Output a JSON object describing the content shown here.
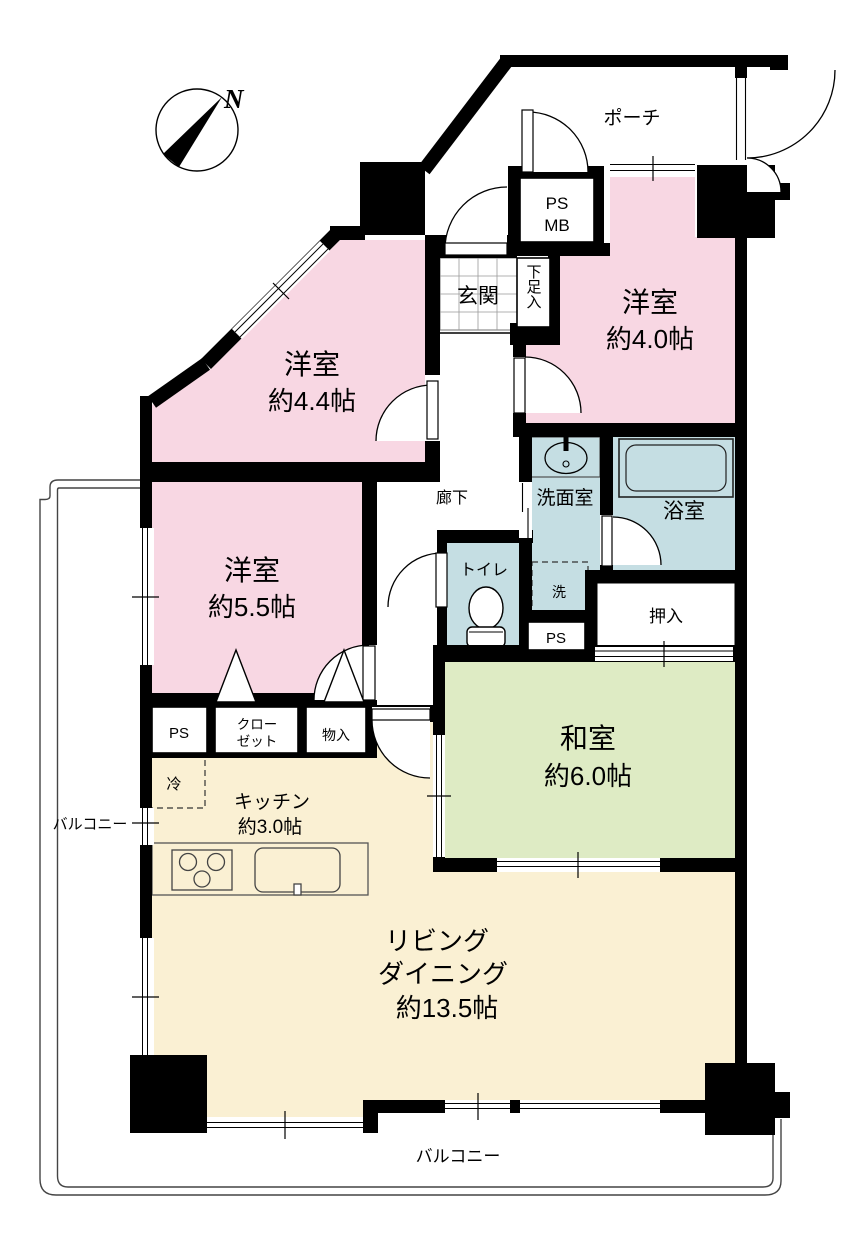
{
  "colors": {
    "pink": "#F8D7E3",
    "blue": "#C5DEE3",
    "green": "#DEEBC4",
    "cream": "#FAF0D3",
    "wall": "#000000",
    "thin": "#333333",
    "white": "#FFFFFF"
  },
  "compass": {
    "north": "N"
  },
  "labels": {
    "porch": "ポーチ",
    "psmb1": "PS",
    "psmb2": "MB",
    "genkan": "玄関",
    "shoebox": "下足入",
    "room40_name": "洋室",
    "room40_size": "約4.0帖",
    "room44_name": "洋室",
    "room44_size": "約4.4帖",
    "room55_name": "洋室",
    "room55_size": "約5.5帖",
    "corridor": "廊下",
    "toilet": "トイレ",
    "washroom": "洗面室",
    "laundry": "洗",
    "bath": "浴室",
    "ps_wash": "PS",
    "oshiire": "押入",
    "washitsu_name": "和室",
    "washitsu_size": "約6.0帖",
    "ps_closet": "PS",
    "closet1": "クロー",
    "closet2": "ゼット",
    "storage": "物入",
    "fridge": "冷",
    "kitchen_name": "キッチン",
    "kitchen_size": "約3.0帖",
    "living1": "リビング",
    "living2": "ダイニング",
    "living3": "約13.5帖",
    "balcony_left": "バルコニー",
    "balcony_bottom": "バルコニー"
  }
}
